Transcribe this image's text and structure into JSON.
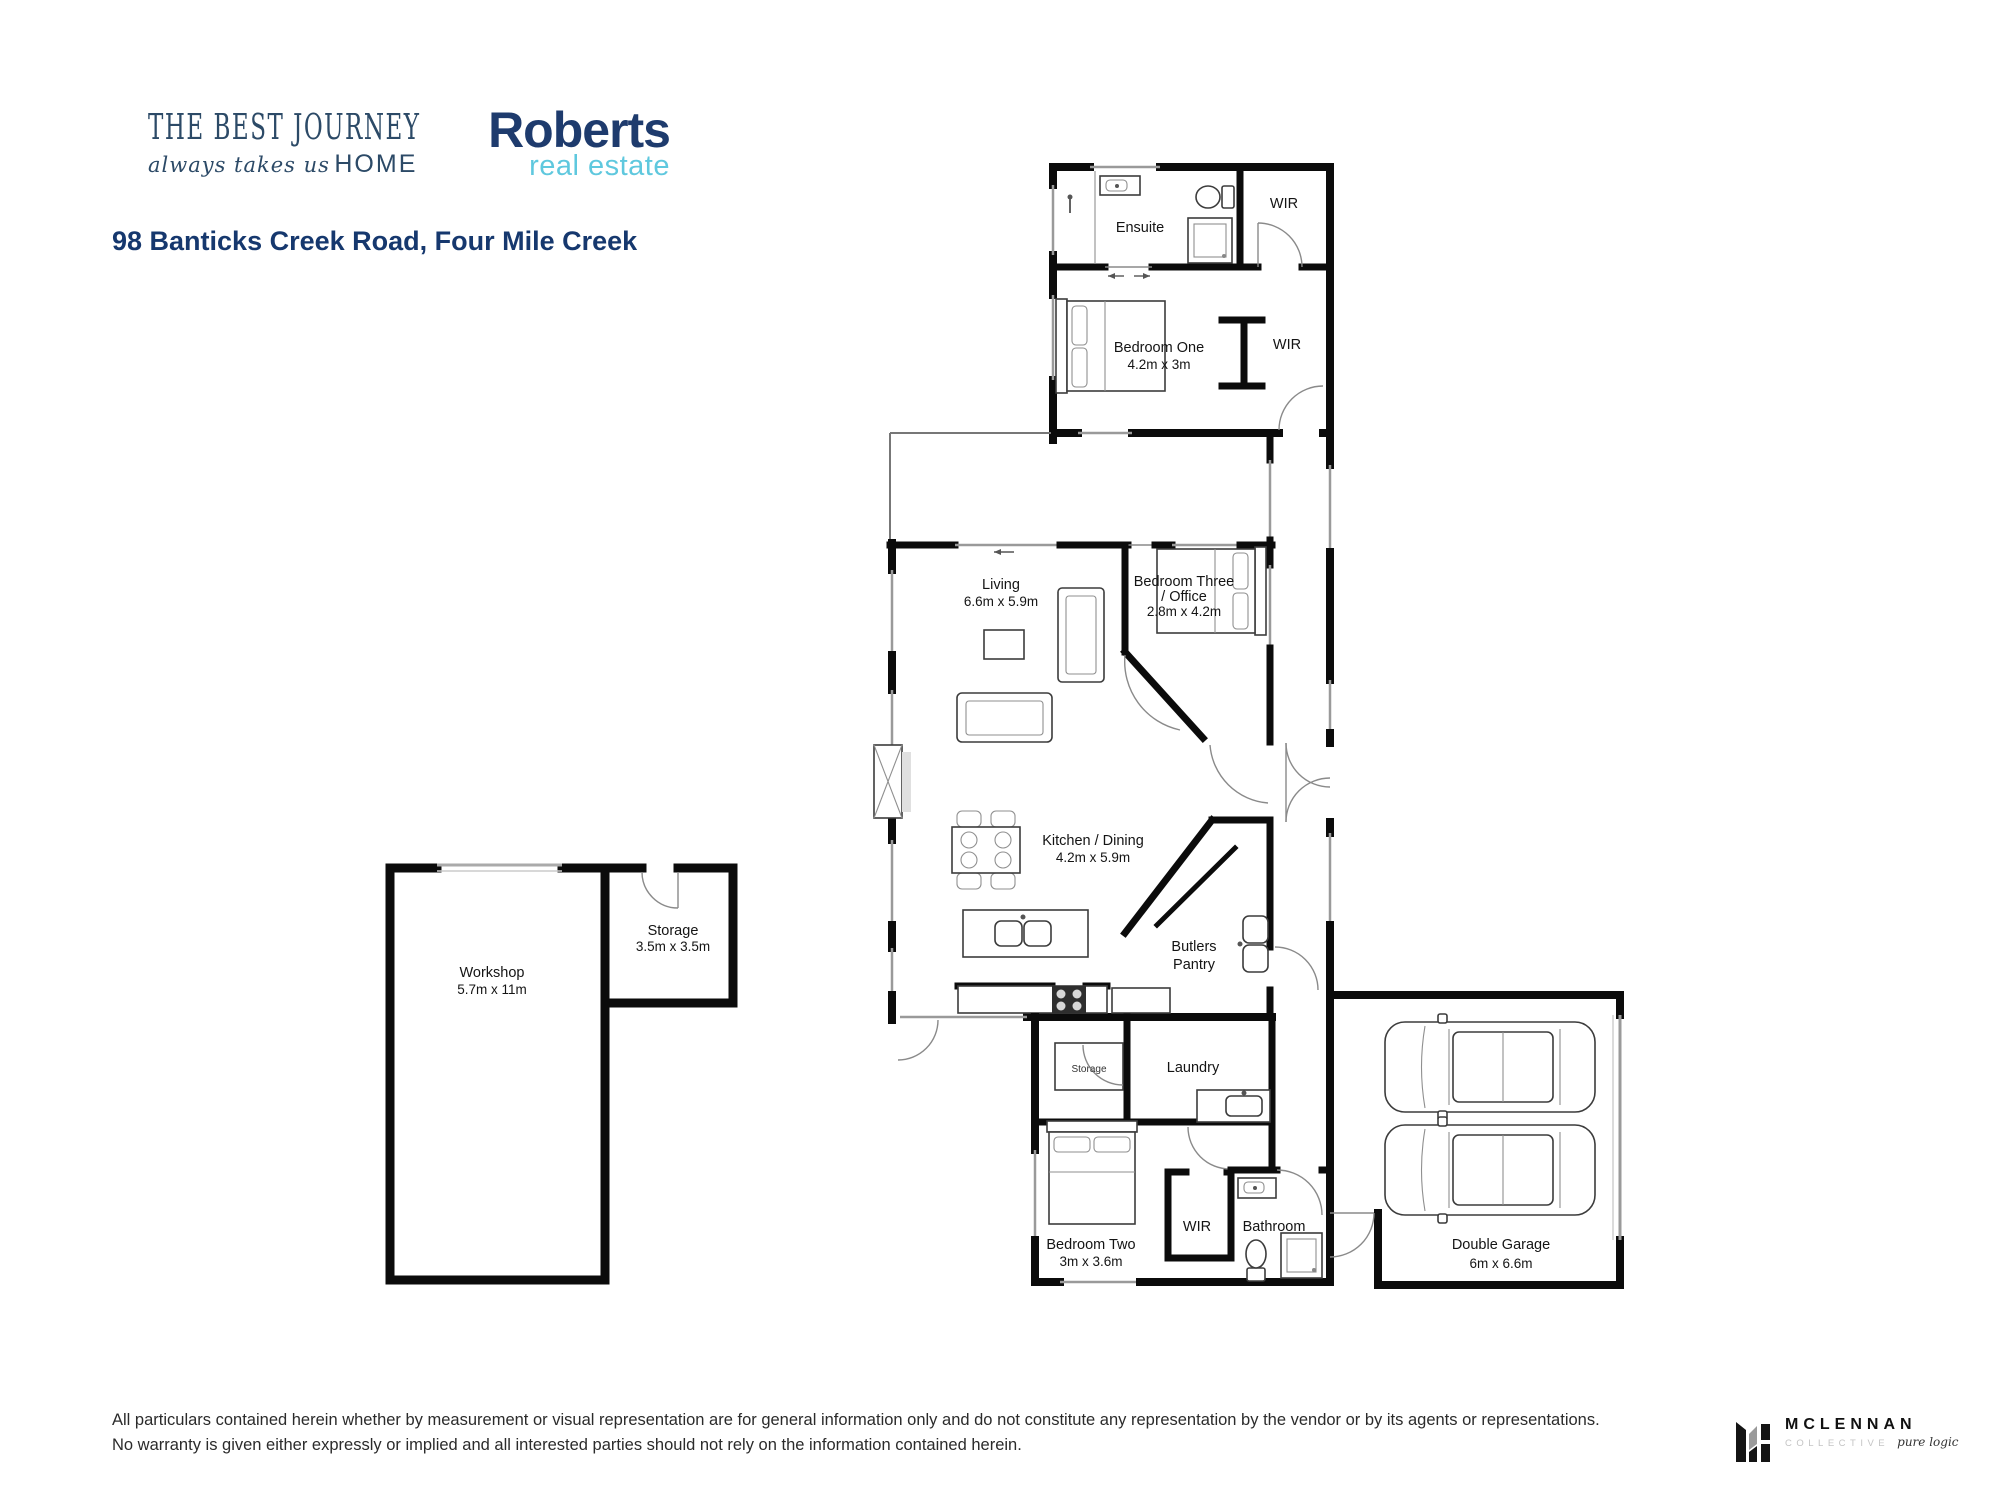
{
  "branding": {
    "journey_logo": {
      "line1": "THE BEST JOURNEY",
      "line2_script": "always takes us",
      "line2_caps": "HOME",
      "color": "#2c4a67"
    },
    "roberts_logo": {
      "name": "Roberts",
      "sub": "real estate",
      "name_color": "#1e3b6d",
      "sub_color": "#5fc8de"
    }
  },
  "address": "98 Banticks Creek Road, Four Mile Creek",
  "floorplan": {
    "rooms": {
      "ensuite": {
        "label": "Ensuite"
      },
      "wir1": {
        "label": "WIR"
      },
      "bedroom_one": {
        "label": "Bedroom One",
        "dims": "4.2m x 3m"
      },
      "wir2": {
        "label": "WIR"
      },
      "living": {
        "label": "Living",
        "dims": "6.6m x 5.9m"
      },
      "bedroom_three": {
        "label": "Bedroom Three",
        "label2": "/ Office",
        "dims": "2.8m x 4.2m"
      },
      "kitchen_dining": {
        "label": "Kitchen / Dining",
        "dims": "4.2m x 5.9m"
      },
      "butlers_pantry": {
        "label": "Butlers",
        "label2": "Pantry"
      },
      "storage_nook": {
        "label": "Storage"
      },
      "laundry": {
        "label": "Laundry"
      },
      "bedroom_two": {
        "label": "Bedroom Two",
        "dims": "3m x 3.6m"
      },
      "wir3": {
        "label": "WIR"
      },
      "bathroom": {
        "label": "Bathroom"
      },
      "double_garage": {
        "label": "Double Garage",
        "dims": "6m x 6.6m"
      },
      "workshop": {
        "label": "Workshop",
        "dims": "5.7m x 11m"
      },
      "storage_outbuilding": {
        "label": "Storage",
        "dims": "3.5m x 3.5m"
      }
    }
  },
  "disclaimer": {
    "line1": "All particulars contained herein whether by measurement or visual representation are for general information only and do not constitute any representation by the vendor or by its agents or representations.",
    "line2": "No warranty is given either expressly or implied and all interested parties should not rely on the information contained herein."
  },
  "footer_logo": {
    "name": "MCLENNAN",
    "sub": "COLLECTIVE",
    "tagline": "pure logic"
  }
}
